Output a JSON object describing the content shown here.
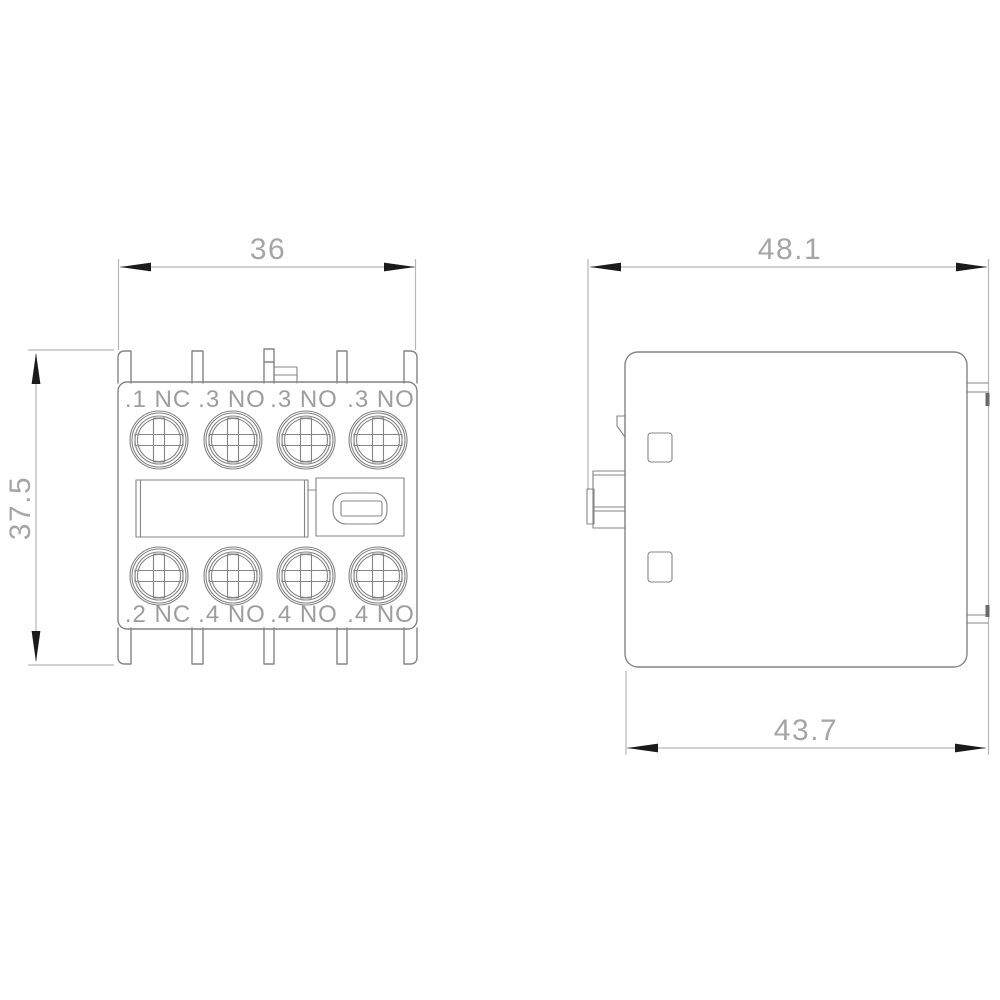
{
  "front_view": {
    "width_dim": "36",
    "height_dim": "37.5",
    "terminals_top": [
      ".1 NC",
      ".3 NO",
      ".3 NO",
      ".3 NO"
    ],
    "terminals_bottom": [
      ".2 NC",
      ".4 NO",
      ".4 NO",
      ".4 NO"
    ]
  },
  "side_view": {
    "width_dim": "48.1",
    "depth_dim": "43.7"
  },
  "colors": {
    "background": "#ffffff",
    "outline": "#848484",
    "dimension_line": "#b6b6b6",
    "dimension_text": "#a5a5a5",
    "terminal_text": "#9d9d9d",
    "arrow": "#1b1b1b"
  }
}
